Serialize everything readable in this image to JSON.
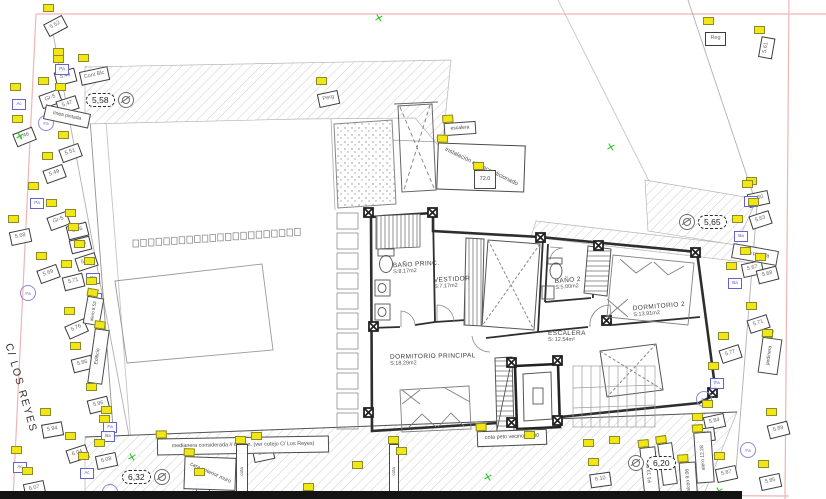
{
  "street": {
    "label": "C/ LOS REYES"
  },
  "colors": {
    "tag_yellow": "#f2e713",
    "marker_blue": "#5a58c8",
    "cross_green": "#2ec82e",
    "frame_pink": "#efb5b5",
    "line_dark": "#2e2e2e"
  },
  "rooms": [
    {
      "name": "BAÑO PRINC.",
      "area": "S:8.17m2",
      "x": 393,
      "y": 261,
      "rot": -3
    },
    {
      "name": "VESTIDOR",
      "area": "S:7.17m2",
      "x": 434,
      "y": 276,
      "rot": -3
    },
    {
      "name": "BAÑO 2",
      "area": "S:5.00m2",
      "x": 555,
      "y": 277,
      "rot": -5
    },
    {
      "name": "DORMITORIO 2",
      "area": "S:13.91m2",
      "x": 633,
      "y": 303,
      "rot": -5
    },
    {
      "name": "ESCALERA",
      "area": "S: 12.54m²",
      "x": 548,
      "y": 330,
      "rot": 0
    },
    {
      "name": "DORMITORIO PRINCIPAL",
      "area": "S:18.29m2",
      "x": 390,
      "y": 353,
      "rot": -1
    }
  ],
  "benchmarks": [
    {
      "v": "5,58",
      "x": 86,
      "y": 92,
      "flip": false
    },
    {
      "v": "5,65",
      "x": 679,
      "y": 214,
      "flip": true
    },
    {
      "v": "6,32",
      "x": 122,
      "y": 469,
      "flip": false
    },
    {
      "v": "6,20",
      "x": 628,
      "y": 455,
      "flip": true
    }
  ],
  "annotations": [
    {
      "text": "escalera",
      "x": 444,
      "y": 122,
      "w": 30,
      "h": 11,
      "rot": -4,
      "trot": 0,
      "fs": 5,
      "tag": true,
      "vert": false
    },
    {
      "text": "instalación aire acondicionado",
      "x": 437,
      "y": 144,
      "w": 86,
      "h": 45,
      "rot": 2,
      "trot": 24,
      "fs": 6,
      "tag": true,
      "vert": false
    },
    {
      "text": "72.0",
      "x": 474,
      "y": 170,
      "w": 20,
      "h": 17,
      "rot": 0,
      "trot": 0,
      "fs": 5.5,
      "tag": true,
      "vert": false
    },
    {
      "text": "medianera considerada // 6,00 m. (ver cotejo C/ Los Reyes)",
      "x": 157,
      "y": 437,
      "w": 170,
      "h": 15,
      "rot": -1,
      "trot": 0,
      "fs": 5.4,
      "tag": true,
      "vert": false
    },
    {
      "text": "cara anterior muro",
      "x": 184,
      "y": 457,
      "w": 50,
      "h": 31,
      "rot": 2,
      "trot": 22,
      "fs": 5.4,
      "tag": true,
      "vert": false
    },
    {
      "text": "cota peto vecino 17.00",
      "x": 477,
      "y": 430,
      "w": 68,
      "h": 14,
      "rot": -2,
      "trot": 0,
      "fs": 5.4,
      "tag": true,
      "vert": false
    },
    {
      "text": "línea pintada",
      "x": 44,
      "y": 109,
      "w": 44,
      "h": 13,
      "rot": 12,
      "trot": 0,
      "fs": 5,
      "tag": false,
      "vert": false
    },
    {
      "text": "línea pintada",
      "x": 732,
      "y": 247,
      "w": 44,
      "h": 13,
      "rot": 10,
      "trot": 0,
      "fs": 5,
      "tag": false,
      "vert": false
    },
    {
      "text": "jardinera",
      "x": 760,
      "y": 338,
      "w": 18,
      "h": 34,
      "rot": 8,
      "trot": 0,
      "fs": 5,
      "tag": true,
      "vert": true
    },
    {
      "text": "alero 12.28",
      "x": 695,
      "y": 432,
      "w": 16,
      "h": 49,
      "rot": -4,
      "trot": 0,
      "fs": 5,
      "tag": true,
      "vert": true
    },
    {
      "text": "balcón 9.06",
      "x": 680,
      "y": 462,
      "w": 15,
      "h": 37,
      "rot": -4,
      "trot": 0,
      "fs": 5,
      "tag": true,
      "vert": true
    },
    {
      "text": "P1 13.60",
      "x": 642,
      "y": 447,
      "w": 14,
      "h": 50,
      "rot": -6,
      "trot": 0,
      "fs": 5,
      "tag": true,
      "vert": true
    },
    {
      "text": "5.80",
      "x": 660,
      "y": 443,
      "w": 13,
      "h": 40,
      "rot": -8,
      "trot": 0,
      "fs": 5,
      "tag": true,
      "vert": true
    },
    {
      "text": "alero 8.53",
      "x": 85,
      "y": 297,
      "w": 15,
      "h": 26,
      "rot": 10,
      "trot": 0,
      "fs": 4.5,
      "tag": true,
      "vert": true
    },
    {
      "text": "Edificio",
      "x": 91,
      "y": 329,
      "w": 13,
      "h": 53,
      "rot": 8,
      "trot": 0,
      "fs": 5,
      "tag": true,
      "vert": true
    },
    {
      "text": "cota",
      "x": 236,
      "y": 444,
      "w": 10,
      "h": 53,
      "rot": 0,
      "trot": 0,
      "fs": 4.5,
      "tag": true,
      "vert": true
    },
    {
      "text": "cota",
      "x": 389,
      "y": 444,
      "w": 8,
      "h": 53,
      "rot": 0,
      "trot": 0,
      "fs": 4.5,
      "tag": true,
      "vert": true
    }
  ],
  "markers": [
    [
      45,
      13,
      "5.52",
      -28
    ],
    [
      55,
      64,
      "5.48",
      -14
    ],
    [
      80,
      63,
      "Cont Blc",
      -12
    ],
    [
      40,
      86,
      "Gr-5",
      -20
    ],
    [
      57,
      92,
      "5.47",
      -18
    ],
    [
      14,
      124,
      "5.46",
      -22
    ],
    [
      60,
      140,
      "5.51",
      -20
    ],
    [
      44,
      161,
      "5.49",
      -20
    ],
    [
      48,
      208,
      "Gr-5",
      -20
    ],
    [
      10,
      224,
      "5.68",
      -12
    ],
    [
      67,
      218,
      "5.66",
      -14
    ],
    [
      70,
      232,
      "Cont",
      -14
    ],
    [
      76,
      249,
      "5.70",
      -18
    ],
    [
      38,
      261,
      "5.69",
      -20
    ],
    [
      63,
      269,
      "5.71",
      -14
    ],
    [
      66,
      316,
      "5.76",
      -24
    ],
    [
      72,
      351,
      "5.86",
      -14
    ],
    [
      88,
      392,
      "5.96",
      -14
    ],
    [
      42,
      417,
      "5.94",
      -10
    ],
    [
      67,
      441,
      "6.04",
      -18
    ],
    [
      96,
      448,
      "6.08",
      -12
    ],
    [
      24,
      476,
      "6.07",
      -12
    ],
    [
      253,
      441,
      "5.98",
      -12
    ],
    [
      318,
      86,
      "Perg",
      -12
    ],
    [
      705,
      26,
      "Reg",
      0
    ],
    [
      748,
      186,
      "5.60",
      -12
    ],
    [
      750,
      207,
      "5.63",
      -18
    ],
    [
      742,
      256,
      "5.67",
      -12
    ],
    [
      757,
      262,
      "5.68",
      -14
    ],
    [
      748,
      311,
      "5.71",
      -18
    ],
    [
      720,
      341,
      "5.77",
      -18
    ],
    [
      704,
      409,
      "5.84",
      -12
    ],
    [
      694,
      422,
      "5.81",
      -8
    ],
    [
      768,
      417,
      "5.89",
      -14
    ],
    [
      716,
      461,
      "5.87",
      -12
    ],
    [
      760,
      469,
      "5.85",
      -12
    ],
    [
      590,
      467,
      "6.10",
      -8
    ],
    [
      756,
      35,
      "5.61",
      -80
    ]
  ],
  "blue_markers": [
    [
      55,
      57,
      "Pa"
    ],
    [
      12,
      92,
      "Ac"
    ],
    [
      30,
      191,
      "Pa"
    ],
    [
      86,
      266,
      "Ba"
    ],
    [
      88,
      286,
      "Id"
    ],
    [
      103,
      415,
      "Fa"
    ],
    [
      101,
      424,
      "Ba"
    ],
    [
      13,
      455,
      "Ac"
    ],
    [
      80,
      461,
      "Ac"
    ],
    [
      744,
      189,
      "Fa"
    ],
    [
      734,
      224,
      "Ba"
    ],
    [
      728,
      271,
      "Ba"
    ],
    [
      710,
      371,
      "Fa"
    ],
    [
      196,
      477,
      "Ba"
    ]
  ],
  "lamps": [
    {
      "x": 38,
      "y": 115,
      "label": "Fa"
    },
    {
      "x": 20,
      "y": 285,
      "label": "Fa"
    },
    {
      "x": 696,
      "y": 391,
      "label": "Fa"
    },
    {
      "x": 740,
      "y": 442,
      "label": "Fa"
    },
    {
      "x": 102,
      "y": 484,
      "label": "Fa"
    }
  ],
  "tags_only": [
    [
      396,
      447
    ],
    [
      583,
      439
    ],
    [
      609,
      436
    ],
    [
      303,
      483
    ],
    [
      762,
      329
    ],
    [
      352,
      461
    ],
    [
      524,
      431
    ]
  ],
  "crosses": [
    [
      374,
      14
    ],
    [
      606,
      143
    ],
    [
      127,
      453
    ],
    [
      483,
      473
    ],
    [
      15,
      132
    ],
    [
      714,
      487
    ]
  ]
}
